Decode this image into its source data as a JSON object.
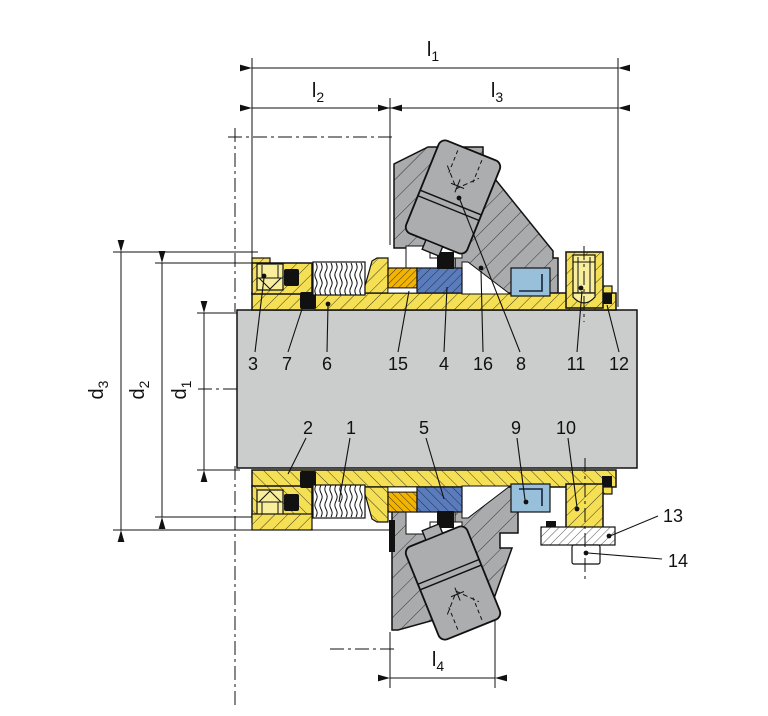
{
  "title": "Mechanical seal cross-section technical drawing",
  "palette": {
    "component_yellow": "#F5DF55",
    "component_light_yellow": "#F9EE9C",
    "seal_face_orange": "#F2B400",
    "seal_ring_dark_blue": "#5B7CBC",
    "ring_light_blue": "#99C0DB",
    "gland_gray": "#AAABAD",
    "shaft_gray": "#CBCCCC",
    "line_black": "#111111",
    "background": "#FFFFFF"
  },
  "dimensions": {
    "l1": {
      "base": "l",
      "sub": "1"
    },
    "l2": {
      "base": "l",
      "sub": "2"
    },
    "l3": {
      "base": "l",
      "sub": "3"
    },
    "l4": {
      "base": "l",
      "sub": "4"
    },
    "d1": {
      "base": "d",
      "sub": "1"
    },
    "d2": {
      "base": "d",
      "sub": "2"
    },
    "d3": {
      "base": "d",
      "sub": "3"
    }
  },
  "part_labels": {
    "upper_row": [
      "3",
      "7",
      "6",
      "15",
      "4",
      "16",
      "8",
      "11",
      "12"
    ],
    "lower_row": [
      "2",
      "1",
      "5",
      "9",
      "10"
    ],
    "right_column": [
      "13",
      "14"
    ]
  }
}
